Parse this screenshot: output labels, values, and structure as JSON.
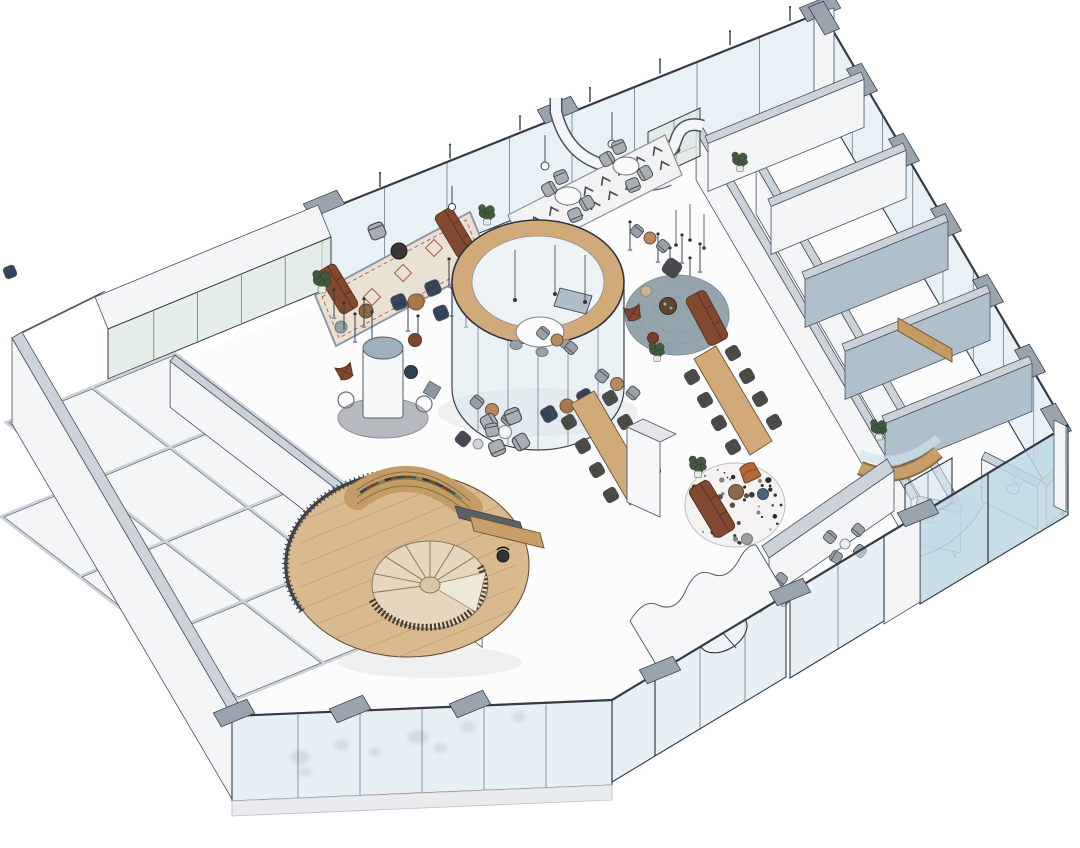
{
  "scene": {
    "type": "axonometric-floor-plan-rendering",
    "description": "isometric cutaway rendering of an office lobby floor with glass facades",
    "visible_text": [],
    "areas": [
      {
        "id": "perimeter-glass-facade",
        "label": "glass curtain wall"
      },
      {
        "id": "lounge-oriental-rug",
        "label": "sofa lounge on patterned rug"
      },
      {
        "id": "cafe-dining-nook",
        "label": "round tables on zigzag rug"
      },
      {
        "id": "circular-glass-meeting-room",
        "label": "round glass room with wood ring"
      },
      {
        "id": "open-workspace-tables",
        "label": "two long wood tables"
      },
      {
        "id": "reading-lounge-blue-rug",
        "label": "leather sofa on round blue rug"
      },
      {
        "id": "lounge-terrazzo-rug",
        "label": "leather sofa on round terrazzo rug"
      },
      {
        "id": "spiral-staircase-library",
        "label": "oak platform, spiral stair, bookshelf"
      },
      {
        "id": "reception-desk",
        "label": "curved desk with task chair"
      },
      {
        "id": "offices-left-wing",
        "label": "cellular offices"
      },
      {
        "id": "meeting-rooms-right-wing",
        "label": "meeting rooms and booths"
      },
      {
        "id": "coffee-counter",
        "label": "curved wood counter"
      },
      {
        "id": "restroom",
        "label": "wc with toilet"
      },
      {
        "id": "entrance-revolving-door",
        "label": "revolving door with wavy canopy"
      },
      {
        "id": "terrace-seating",
        "label": "outdoor chairs behind glass"
      },
      {
        "id": "balustrade-frosted",
        "label": "frosted glass with furniture silhouettes"
      }
    ]
  },
  "palette": {
    "floor": "#fcfcfd",
    "wall_face": "#f4f5f7",
    "wall_cap": "#ccd2d9",
    "wall_edge": "#4a525e",
    "wall_blue": "#b0bfcc",
    "glass": "#d6e7ee",
    "glass_tint": "#bdd8e5",
    "glass_green": "#dde9e2",
    "frame": "#333b46",
    "wood": "#d2a978",
    "wood_deep": "#c59a63",
    "oak_floor": "#dab98f",
    "oak_edge": "#6b5335",
    "leather": "#81492f",
    "orange_chair": "#b06a3a",
    "navy": "#31425c",
    "rug_blue": "#93a4ac",
    "rug_beige": "#e9e2d4",
    "rug_zigzag": "#f2f2f2",
    "terrazzo": "#f4f3f1",
    "plant": "#41593c",
    "chair_gray": "#a8aeb3",
    "chair_dark": "#4b4a42",
    "wicker": "#9aa0a5",
    "metal": "#3a3f46"
  }
}
